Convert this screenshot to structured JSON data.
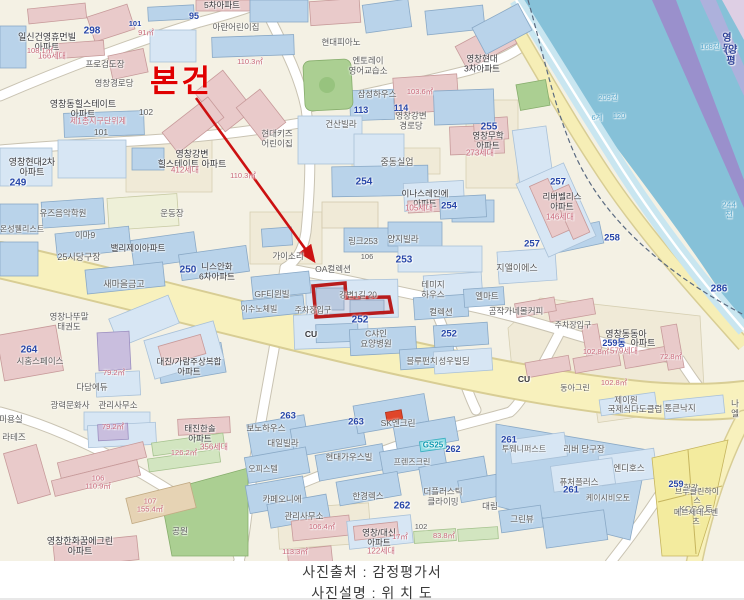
{
  "caption": {
    "source": "사진출처 : 감정평가서",
    "description": "사진설명 : 위 치 도"
  },
  "subject": {
    "label": "본건",
    "color": "#e00000"
  },
  "colors": {
    "highlight_red": "#b81c1c",
    "road_yellow": "#f8f1bd",
    "water_blue": "#86c1d8",
    "bridge_purple": "#9a90cc",
    "building_blue": "#b9d3ea",
    "building_pink": "#e9caca",
    "park_green": "#abcf92"
  },
  "map_labels": [
    {
      "t": "5차아파트",
      "x": 222,
      "y": 6,
      "s": 8.5,
      "c": "d"
    },
    {
      "t": "95",
      "x": 194,
      "y": 16,
      "s": 9,
      "c": "b"
    },
    {
      "t": "일신건영휴먼빌\n아파트",
      "x": 47,
      "y": 42,
      "s": 9,
      "c": "d"
    },
    {
      "t": "298",
      "x": 92,
      "y": 31,
      "s": 10,
      "c": "b"
    },
    {
      "t": "101",
      "x": 135,
      "y": 24,
      "s": 7.5,
      "c": "b"
    },
    {
      "t": "91㎡",
      "x": 146,
      "y": 33,
      "s": 7.5,
      "c": "p"
    },
    {
      "t": "166세대",
      "x": 52,
      "y": 57,
      "s": 8,
      "c": "p"
    },
    {
      "t": "108.1㎡",
      "x": 40,
      "y": 51,
      "s": 7.5,
      "c": "p"
    },
    {
      "t": "프로검도장",
      "x": 105,
      "y": 65,
      "s": 8.5,
      "c": "g"
    },
    {
      "t": "아란어린이집",
      "x": 236,
      "y": 28,
      "s": 8.5,
      "c": "g"
    },
    {
      "t": "영창경로당",
      "x": 114,
      "y": 84,
      "s": 8.5,
      "c": "g"
    },
    {
      "t": "110.3㎡",
      "x": 250,
      "y": 62,
      "s": 7.5,
      "c": "p"
    },
    {
      "t": "영창동힐스테이트\n아파트",
      "x": 83,
      "y": 109,
      "s": 9,
      "c": "d"
    },
    {
      "t": "제1종지구단위계",
      "x": 98,
      "y": 122,
      "s": 8,
      "c": "p"
    },
    {
      "t": "102",
      "x": 146,
      "y": 113,
      "s": 8.5,
      "c": "g"
    },
    {
      "t": "101",
      "x": 101,
      "y": 133,
      "s": 8.5,
      "c": "g"
    },
    {
      "t": "영창현대2차\n아파트",
      "x": 32,
      "y": 167,
      "s": 9,
      "c": "d"
    },
    {
      "t": "249",
      "x": 18,
      "y": 183,
      "s": 10,
      "c": "b"
    },
    {
      "t": "현대피아노",
      "x": 341,
      "y": 43,
      "s": 8.5,
      "c": "g"
    },
    {
      "t": "엔토레이\n영어교습소",
      "x": 368,
      "y": 66,
      "s": 8.5,
      "c": "g"
    },
    {
      "t": "삼성하우스",
      "x": 377,
      "y": 95,
      "s": 8.5,
      "c": "g"
    },
    {
      "t": "113",
      "x": 361,
      "y": 110,
      "s": 9,
      "c": "b"
    },
    {
      "t": "114",
      "x": 401,
      "y": 108,
      "s": 9,
      "c": "b"
    },
    {
      "t": "영창강변\n경로당",
      "x": 411,
      "y": 121,
      "s": 8.5,
      "c": "g"
    },
    {
      "t": "영창현대\n3차아파트",
      "x": 482,
      "y": 64,
      "s": 8.5,
      "c": "d"
    },
    {
      "t": "255",
      "x": 489,
      "y": 127,
      "s": 10,
      "c": "b"
    },
    {
      "t": "영창무학\n아파트",
      "x": 488,
      "y": 141,
      "s": 8.5,
      "c": "d"
    },
    {
      "t": "273세대",
      "x": 480,
      "y": 154,
      "s": 8,
      "c": "p"
    },
    {
      "t": "영창강변\n힐스테이트 아파트",
      "x": 192,
      "y": 159,
      "s": 9,
      "c": "d"
    },
    {
      "t": "412세대",
      "x": 185,
      "y": 171,
      "s": 8,
      "c": "p"
    },
    {
      "t": "110.3㎡",
      "x": 243,
      "y": 176,
      "s": 7.5,
      "c": "p"
    },
    {
      "t": "103.6㎡",
      "x": 420,
      "y": 92,
      "s": 7.5,
      "c": "p"
    },
    {
      "t": "현대키즈\n어린이집",
      "x": 277,
      "y": 139,
      "s": 8.5,
      "c": "g"
    },
    {
      "t": "건산빌라",
      "x": 341,
      "y": 125,
      "s": 8.5,
      "c": "g"
    },
    {
      "t": "중동실업",
      "x": 397,
      "y": 162,
      "s": 9,
      "c": "g"
    },
    {
      "t": "254",
      "x": 364,
      "y": 182,
      "s": 10,
      "c": "b"
    },
    {
      "t": "영동",
      "x": 727,
      "y": 44,
      "s": 10,
      "c": "n"
    },
    {
      "t": "(양평",
      "x": 731,
      "y": 56,
      "s": 10,
      "c": "n"
    },
    {
      "t": "168천",
      "x": 710,
      "y": 47,
      "s": 7.5,
      "c": "w"
    },
    {
      "t": "209천",
      "x": 608,
      "y": 98,
      "s": 7.5,
      "c": "w"
    },
    {
      "t": "6계",
      "x": 597,
      "y": 118,
      "s": 7.5,
      "c": "w"
    },
    {
      "t": "120",
      "x": 619,
      "y": 116,
      "s": 7.5,
      "c": "w"
    },
    {
      "t": "244천",
      "x": 729,
      "y": 210,
      "s": 8.5,
      "c": "w"
    },
    {
      "t": "286",
      "x": 719,
      "y": 289,
      "s": 10,
      "c": "b"
    },
    {
      "t": "유즈음악학원",
      "x": 63,
      "y": 214,
      "s": 8.5,
      "c": "g"
    },
    {
      "t": "온성웰리스트",
      "x": 22,
      "y": 230,
      "s": 8,
      "c": "g"
    },
    {
      "t": "이마9",
      "x": 85,
      "y": 236,
      "s": 8.5,
      "c": "g"
    },
    {
      "t": "운동장",
      "x": 172,
      "y": 214,
      "s": 8.5,
      "c": "g"
    },
    {
      "t": "밸리제이아파트",
      "x": 138,
      "y": 249,
      "s": 8.5,
      "c": "d"
    },
    {
      "t": "25시당구장",
      "x": 79,
      "y": 257,
      "s": 9,
      "c": "g"
    },
    {
      "t": "250",
      "x": 188,
      "y": 270,
      "s": 10,
      "c": "b"
    },
    {
      "t": "니스안화\n6차아파트",
      "x": 217,
      "y": 272,
      "s": 8.5,
      "c": "d"
    },
    {
      "t": "새마을금고",
      "x": 124,
      "y": 284,
      "s": 9,
      "c": "g"
    },
    {
      "t": "264",
      "x": 29,
      "y": 350,
      "s": 10,
      "c": "b"
    },
    {
      "t": "시홈스페이스",
      "x": 40,
      "y": 362,
      "s": 8.5,
      "c": "g"
    },
    {
      "t": "영창나뚜말\n태권도",
      "x": 69,
      "y": 322,
      "s": 8.5,
      "c": "g"
    },
    {
      "t": "대진/가람주상복합\n아파트",
      "x": 189,
      "y": 367,
      "s": 8.5,
      "c": "d"
    },
    {
      "t": "다담에듀",
      "x": 92,
      "y": 388,
      "s": 8.5,
      "c": "g"
    },
    {
      "t": "79.2㎡",
      "x": 114,
      "y": 373,
      "s": 7.5,
      "c": "p"
    },
    {
      "t": "가이소리",
      "x": 288,
      "y": 257,
      "s": 8.5,
      "c": "g"
    },
    {
      "t": "OA컬렉션",
      "x": 333,
      "y": 270,
      "s": 8.5,
      "c": "g"
    },
    {
      "t": "GF티윈빌",
      "x": 272,
      "y": 295,
      "s": 8.5,
      "c": "g"
    },
    {
      "t": "이수노체빌",
      "x": 259,
      "y": 310,
      "s": 8,
      "c": "g"
    },
    {
      "t": "주차장입구",
      "x": 313,
      "y": 311,
      "s": 8,
      "c": "g"
    },
    {
      "t": "CU",
      "x": 311,
      "y": 335,
      "s": 8.5,
      "c": "d",
      "bd": 1
    },
    {
      "t": "링크253",
      "x": 363,
      "y": 242,
      "s": 8.5,
      "c": "g"
    },
    {
      "t": "양지빌라",
      "x": 403,
      "y": 240,
      "s": 8.5,
      "c": "g"
    },
    {
      "t": "253",
      "x": 404,
      "y": 260,
      "s": 10,
      "c": "b"
    },
    {
      "t": "106",
      "x": 367,
      "y": 257,
      "s": 7.5,
      "c": "g"
    },
    {
      "t": "강변1길 20",
      "x": 358,
      "y": 296,
      "s": 8,
      "c": "g"
    },
    {
      "t": "252",
      "x": 360,
      "y": 320,
      "s": 10,
      "c": "b"
    },
    {
      "t": "C샤인\n요양병원",
      "x": 376,
      "y": 339,
      "s": 8.5,
      "c": "g"
    },
    {
      "t": "테미지\n하우스",
      "x": 433,
      "y": 290,
      "s": 8.5,
      "c": "g"
    },
    {
      "t": "컬렉션",
      "x": 441,
      "y": 313,
      "s": 8.5,
      "c": "g"
    },
    {
      "t": "252",
      "x": 449,
      "y": 335,
      "s": 9.5,
      "c": "b"
    },
    {
      "t": "블루펀치",
      "x": 422,
      "y": 362,
      "s": 8.5,
      "c": "g"
    },
    {
      "t": "성우빌딩",
      "x": 454,
      "y": 362,
      "s": 8.5,
      "c": "g"
    },
    {
      "t": "엘마트",
      "x": 487,
      "y": 297,
      "s": 8.5,
      "c": "g"
    },
    {
      "t": "곰작가네몰커피",
      "x": 516,
      "y": 312,
      "s": 8.5,
      "c": "g"
    },
    {
      "t": "이나스레인에\n아파트",
      "x": 425,
      "y": 199,
      "s": 8.5,
      "c": "d"
    },
    {
      "t": "105세대",
      "x": 419,
      "y": 209,
      "s": 8,
      "c": "p"
    },
    {
      "t": "254",
      "x": 449,
      "y": 207,
      "s": 9.5,
      "c": "b"
    },
    {
      "t": "리버벨리스\n아파트",
      "x": 562,
      "y": 202,
      "s": 8.5,
      "c": "d"
    },
    {
      "t": "146세대",
      "x": 560,
      "y": 218,
      "s": 8,
      "c": "p"
    },
    {
      "t": "257",
      "x": 558,
      "y": 183,
      "s": 9.5,
      "c": "b"
    },
    {
      "t": "257",
      "x": 532,
      "y": 245,
      "s": 9.5,
      "c": "b"
    },
    {
      "t": "지앨이에스",
      "x": 517,
      "y": 268,
      "s": 9,
      "c": "g"
    },
    {
      "t": "258",
      "x": 612,
      "y": 239,
      "s": 9.5,
      "c": "b"
    },
    {
      "t": "주차장입구",
      "x": 573,
      "y": 326,
      "s": 8,
      "c": "g"
    },
    {
      "t": "영창동동아",
      "x": 626,
      "y": 334,
      "s": 9,
      "c": "d"
    },
    {
      "t": "259동",
      "x": 614,
      "y": 343,
      "s": 9,
      "c": "b"
    },
    {
      "t": "아파트",
      "x": 643,
      "y": 343,
      "s": 9,
      "c": "d"
    },
    {
      "t": "579세대",
      "x": 624,
      "y": 352,
      "s": 8,
      "c": "p"
    },
    {
      "t": "102.8㎡",
      "x": 596,
      "y": 352,
      "s": 7.5,
      "c": "p"
    },
    {
      "t": "102.8㎡",
      "x": 614,
      "y": 383,
      "s": 7.5,
      "c": "p"
    },
    {
      "t": "72.8㎡",
      "x": 671,
      "y": 357,
      "s": 7.5,
      "c": "p"
    },
    {
      "t": "CU",
      "x": 524,
      "y": 380,
      "s": 8.5,
      "c": "d",
      "bd": 1
    },
    {
      "t": "동아그린",
      "x": 575,
      "y": 389,
      "s": 8,
      "c": "g"
    },
    {
      "t": "광력문화사",
      "x": 70,
      "y": 406,
      "s": 8.5,
      "c": "g"
    },
    {
      "t": "관리사무소",
      "x": 118,
      "y": 406,
      "s": 8.5,
      "c": "g"
    },
    {
      "t": "미용실",
      "x": 11,
      "y": 420,
      "s": 8.5,
      "c": "g"
    },
    {
      "t": "라테즈",
      "x": 14,
      "y": 438,
      "s": 8.5,
      "c": "g"
    },
    {
      "t": "79.2㎡",
      "x": 113,
      "y": 427,
      "s": 7.5,
      "c": "p"
    },
    {
      "t": "태진한솔\n아파트",
      "x": 200,
      "y": 434,
      "s": 8.5,
      "c": "d"
    },
    {
      "t": "356세대",
      "x": 214,
      "y": 448,
      "s": 8,
      "c": "p"
    },
    {
      "t": "126.2㎡",
      "x": 184,
      "y": 453,
      "s": 7.5,
      "c": "p"
    },
    {
      "t": "106\n110.9㎡",
      "x": 98,
      "y": 483,
      "s": 7.5,
      "c": "p"
    },
    {
      "t": "107\n155.4㎡",
      "x": 150,
      "y": 506,
      "s": 7.5,
      "c": "p"
    },
    {
      "t": "영창한화꿈에그린\n아파트",
      "x": 80,
      "y": 546,
      "s": 9,
      "c": "d"
    },
    {
      "t": "공원",
      "x": 180,
      "y": 532,
      "s": 8.5,
      "c": "g"
    },
    {
      "t": "263",
      "x": 288,
      "y": 417,
      "s": 9.5,
      "c": "b"
    },
    {
      "t": "263",
      "x": 356,
      "y": 423,
      "s": 9.5,
      "c": "b"
    },
    {
      "t": "보노하우스",
      "x": 266,
      "y": 429,
      "s": 8.5,
      "c": "g"
    },
    {
      "t": "대일빌라",
      "x": 283,
      "y": 444,
      "s": 8.5,
      "c": "g"
    },
    {
      "t": "SK엔크린",
      "x": 398,
      "y": 424,
      "s": 8.5,
      "c": "g"
    },
    {
      "t": "GS25",
      "x": 433,
      "y": 446,
      "s": 8,
      "c": "t"
    },
    {
      "t": "262",
      "x": 453,
      "y": 449,
      "s": 9,
      "c": "b"
    },
    {
      "t": "현대가우스빌",
      "x": 349,
      "y": 458,
      "s": 8.5,
      "c": "g"
    },
    {
      "t": "프렌즈크린",
      "x": 412,
      "y": 463,
      "s": 8,
      "c": "g"
    },
    {
      "t": "오피스텔",
      "x": 263,
      "y": 470,
      "s": 8,
      "c": "g"
    },
    {
      "t": "한경렉스",
      "x": 368,
      "y": 497,
      "s": 8.5,
      "c": "g"
    },
    {
      "t": "262",
      "x": 402,
      "y": 506,
      "s": 10,
      "c": "b"
    },
    {
      "t": "더플러스틱\n클라이밍",
      "x": 443,
      "y": 497,
      "s": 8.5,
      "c": "g"
    },
    {
      "t": "카페오니에",
      "x": 282,
      "y": 500,
      "s": 8.5,
      "c": "g"
    },
    {
      "t": "관리사무소",
      "x": 304,
      "y": 517,
      "s": 8.5,
      "c": "g"
    },
    {
      "t": "106.4㎡",
      "x": 322,
      "y": 527,
      "s": 7.5,
      "c": "p"
    },
    {
      "t": "영창/대신\n아파트",
      "x": 379,
      "y": 538,
      "s": 8.5,
      "c": "d"
    },
    {
      "t": "122세대",
      "x": 381,
      "y": 552,
      "s": 8,
      "c": "p"
    },
    {
      "t": "102",
      "x": 421,
      "y": 527,
      "s": 7.5,
      "c": "g"
    },
    {
      "t": "17㎡",
      "x": 400,
      "y": 537,
      "s": 7.5,
      "c": "p"
    },
    {
      "t": "83.8㎡",
      "x": 444,
      "y": 536,
      "s": 7.5,
      "c": "p"
    },
    {
      "t": "113.3㎡",
      "x": 295,
      "y": 552,
      "s": 7.5,
      "c": "p"
    },
    {
      "t": "대림",
      "x": 490,
      "y": 507,
      "s": 8.5,
      "c": "g"
    },
    {
      "t": "제이원",
      "x": 626,
      "y": 401,
      "s": 8.5,
      "c": "g"
    },
    {
      "t": "국제식다도클럽",
      "x": 635,
      "y": 410,
      "s": 8.5,
      "c": "g"
    },
    {
      "t": "통큰낙지",
      "x": 680,
      "y": 409,
      "s": 8.5,
      "c": "g"
    },
    {
      "t": "나엘",
      "x": 735,
      "y": 409,
      "s": 8.5,
      "c": "g"
    },
    {
      "t": "261",
      "x": 509,
      "y": 441,
      "s": 9.5,
      "c": "b"
    },
    {
      "t": "투웨니퍼스트",
      "x": 524,
      "y": 450,
      "s": 8,
      "c": "g"
    },
    {
      "t": "리버 당구장",
      "x": 584,
      "y": 450,
      "s": 8.5,
      "c": "g"
    },
    {
      "t": "엔디호스",
      "x": 629,
      "y": 469,
      "s": 8.5,
      "c": "g"
    },
    {
      "t": "퓨처플러스",
      "x": 579,
      "y": 483,
      "s": 8.5,
      "c": "g"
    },
    {
      "t": "261",
      "x": 571,
      "y": 491,
      "s": 9.5,
      "c": "b"
    },
    {
      "t": "케이시비오토",
      "x": 608,
      "y": 499,
      "s": 8,
      "c": "g"
    },
    {
      "t": "그린뷰",
      "x": 522,
      "y": 520,
      "s": 8.5,
      "c": "g"
    },
    {
      "t": "259",
      "x": 676,
      "y": 484,
      "s": 9,
      "c": "b"
    },
    {
      "t": "한강",
      "x": 691,
      "y": 489,
      "s": 8,
      "c": "g"
    },
    {
      "t": "브루클린하이스",
      "x": 697,
      "y": 497,
      "s": 8,
      "c": "g"
    },
    {
      "t": "KCC오토",
      "x": 696,
      "y": 510,
      "s": 8.5,
      "c": "g"
    },
    {
      "t": "메르세데스벤츠",
      "x": 696,
      "y": 518,
      "s": 8,
      "c": "g"
    }
  ]
}
